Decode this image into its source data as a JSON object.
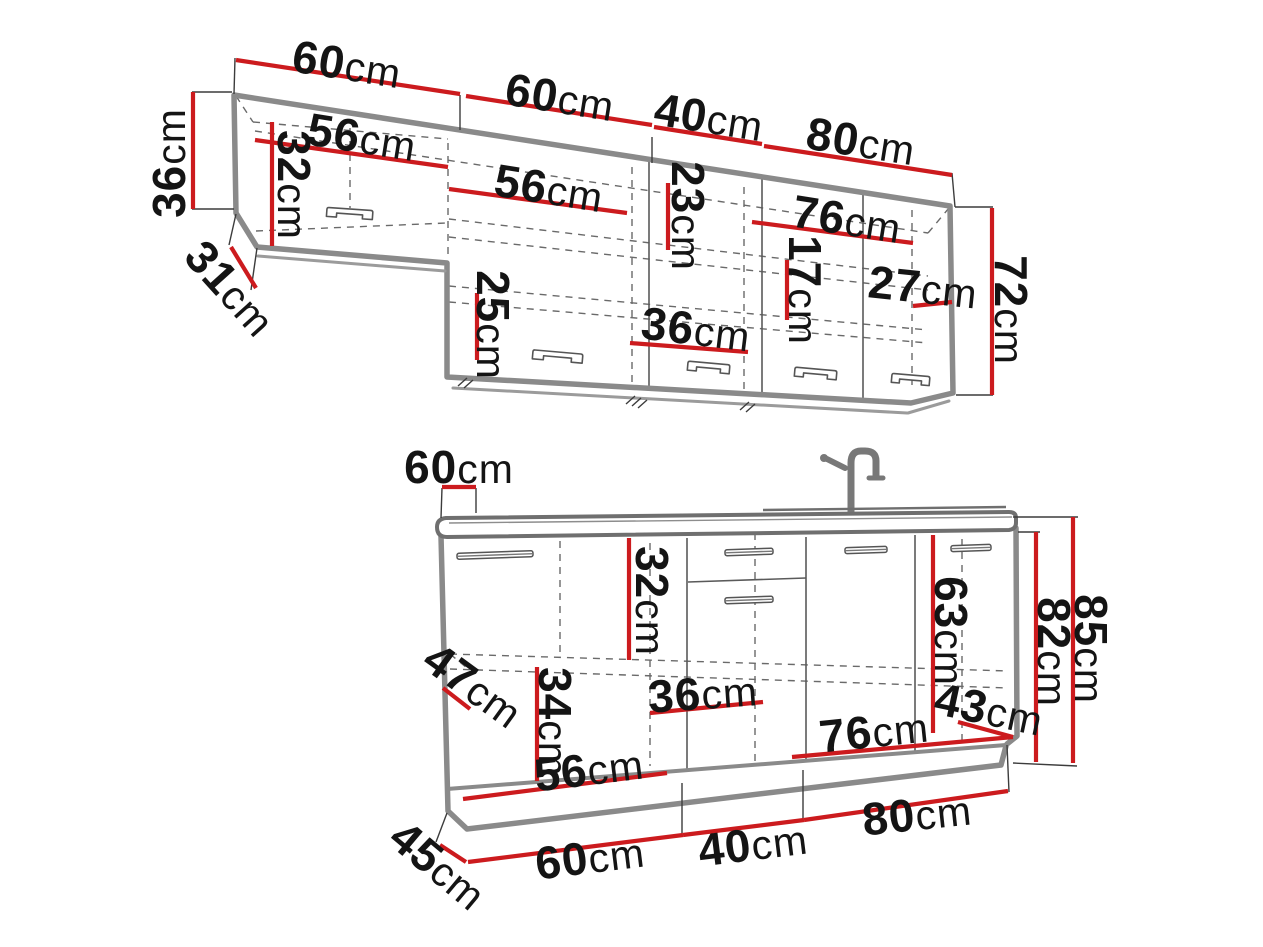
{
  "figure": {
    "kind": "kitchen-cabinet-dimension-diagram",
    "unit": "cm",
    "colors": {
      "dimension_line": "#cc1b1e",
      "cabinet_outline": "#8a8a8a",
      "label_text": "#141414",
      "background": "#ffffff"
    }
  },
  "upper": {
    "w60a": {
      "v": "60",
      "u": "cm"
    },
    "w60b": {
      "v": "60",
      "u": "cm"
    },
    "w40": {
      "v": "40",
      "u": "cm"
    },
    "w80": {
      "v": "80",
      "u": "cm"
    },
    "h36": {
      "v": "36",
      "u": "cm"
    },
    "d31": {
      "v": "31",
      "u": "cm"
    },
    "w56a": {
      "v": "56",
      "u": "cm"
    },
    "h32": {
      "v": "32",
      "u": "cm"
    },
    "w56b": {
      "v": "56",
      "u": "cm"
    },
    "h23": {
      "v": "23",
      "u": "cm"
    },
    "w76": {
      "v": "76",
      "u": "cm"
    },
    "h17": {
      "v": "17",
      "u": "cm"
    },
    "w27": {
      "v": "27",
      "u": "cm"
    },
    "h25": {
      "v": "25",
      "u": "cm"
    },
    "w36": {
      "v": "36",
      "u": "cm"
    },
    "h72": {
      "v": "72",
      "u": "cm"
    }
  },
  "base": {
    "d60": {
      "v": "60",
      "u": "cm"
    },
    "h32": {
      "v": "32",
      "u": "cm"
    },
    "h63": {
      "v": "63",
      "u": "cm"
    },
    "h82": {
      "v": "82",
      "u": "cm"
    },
    "h85": {
      "v": "85",
      "u": "cm"
    },
    "d47": {
      "v": "47",
      "u": "cm"
    },
    "h34": {
      "v": "34",
      "u": "cm"
    },
    "w36": {
      "v": "36",
      "u": "cm"
    },
    "w56": {
      "v": "56",
      "u": "cm"
    },
    "w76": {
      "v": "76",
      "u": "cm"
    },
    "d43": {
      "v": "43",
      "u": "cm"
    },
    "d45": {
      "v": "45",
      "u": "cm"
    },
    "w60": {
      "v": "60",
      "u": "cm"
    },
    "w40": {
      "v": "40",
      "u": "cm"
    },
    "w80": {
      "v": "80",
      "u": "cm"
    }
  }
}
